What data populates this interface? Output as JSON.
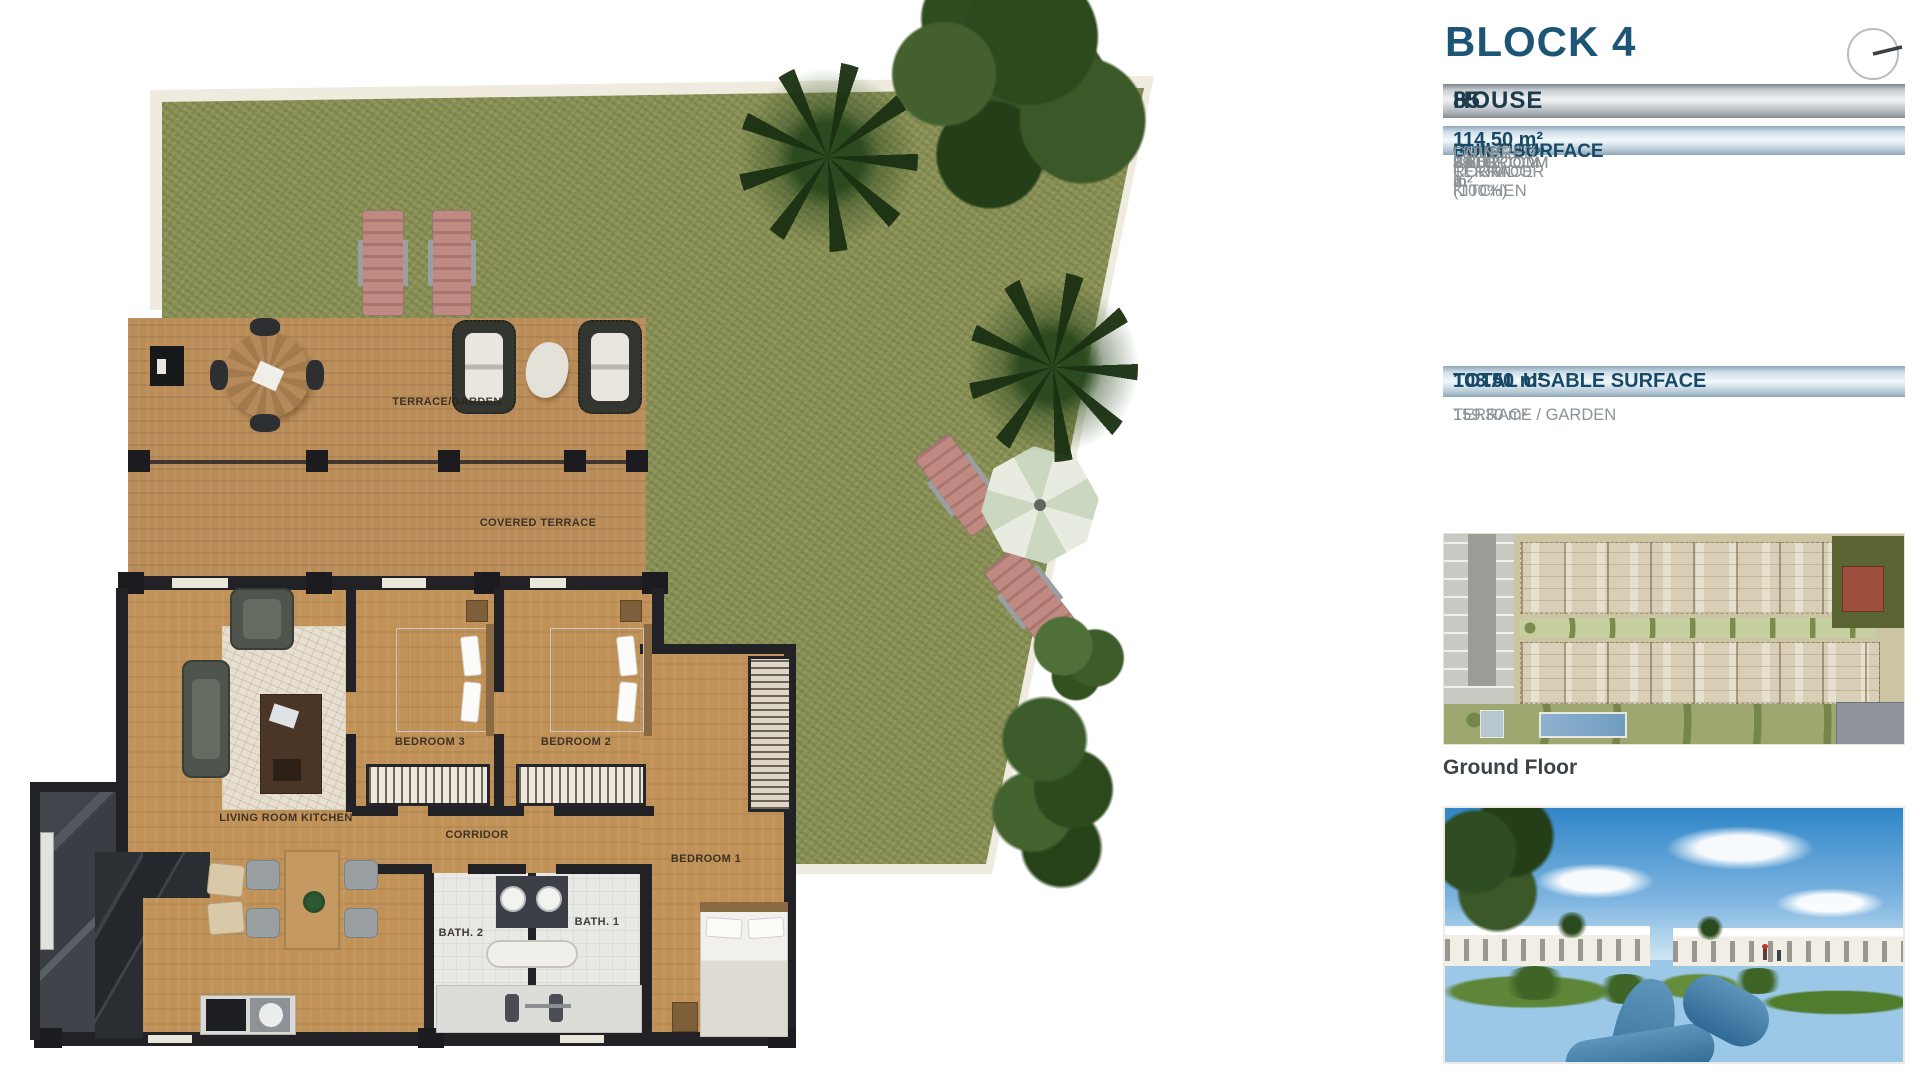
{
  "panel": {
    "block_title": "BLOCK 4",
    "house_label": "HOUSE",
    "house_number": "85",
    "built_surface_label": "BUILT SURFACE",
    "built_surface_note": "(Terrace 100%)",
    "built_surface_value": "114.50 m²",
    "rooms": [
      {
        "label": "LIVING ROOM KITCHEN",
        "value": "29.50 m²"
      },
      {
        "label": "BEDROOM 1",
        "value": "14.60 m²"
      },
      {
        "label": "BEDROOM 2",
        "value": "9.70 m²"
      },
      {
        "label": "BEDROOM 3",
        "value": "9.70 m²"
      },
      {
        "label": "BATHROOM 1",
        "value": "3.80 m²"
      },
      {
        "label": "BATHROOM 2",
        "value": "3.50 m²"
      },
      {
        "label": "CORRIDOR",
        "value": "1.70 m²"
      },
      {
        "label": "COVERED TERRACE (100%)",
        "value": "31.00 m²"
      }
    ],
    "total_label": "TOTAL USABLE SURFACE",
    "total_value": "103.50 m²",
    "terrace_garden_label": "TERRACE / GARDEN",
    "terrace_garden_value": "159.30 m²",
    "siteplan_caption": "Ground Floor",
    "icons": {
      "top_right": "compass-icon"
    }
  },
  "floorplan": {
    "labels": {
      "terrace_garden": "TERRACE/GARDEN",
      "covered_terrace": "COVERED TERRACE",
      "living": "LIVING ROOM KITCHEN",
      "bedroom1": "BEDROOM 1",
      "bedroom2": "BEDROOM 2",
      "bedroom3": "BEDROOM 3",
      "corridor": "CORRIDOR",
      "bath1": "BATH. 1",
      "bath2": "BATH. 2"
    }
  },
  "colors": {
    "accent_navy": "#1d5577",
    "bar_blue": "#9db4c6",
    "grass_green": "#8a9156",
    "wood_tan": "#b98c58",
    "wall_dark": "#212126",
    "row_gray": "#8d9296"
  }
}
